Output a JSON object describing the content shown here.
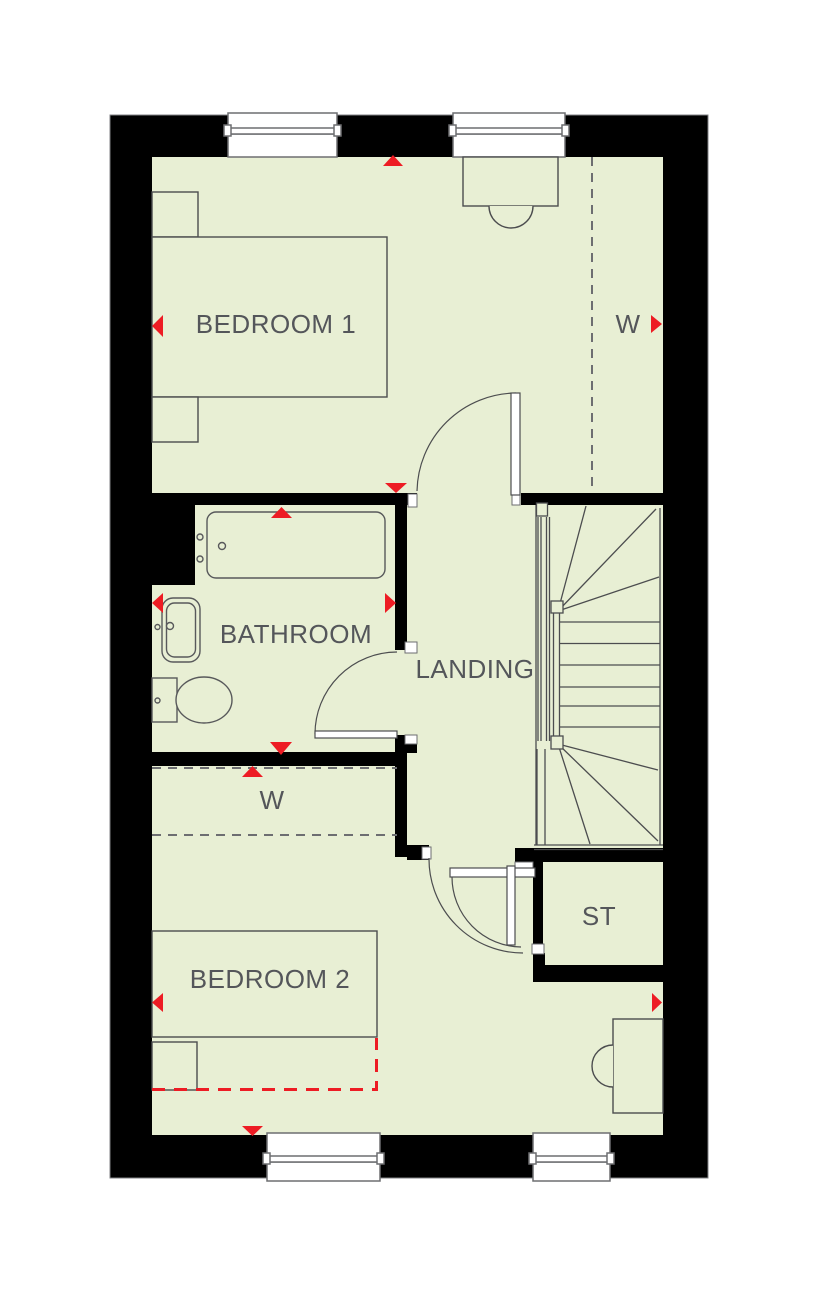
{
  "colors": {
    "floor": "#e8efd4",
    "wall": "#000000",
    "marker": "#ed1c24",
    "label": "#54565a",
    "line": "#4c4d4f",
    "fixture": "#58595b",
    "frame": "#6d6e71"
  },
  "rooms": {
    "bedroom1": {
      "label": "BEDROOM 1"
    },
    "wardrobe1": {
      "label": "W"
    },
    "bathroom": {
      "label": "BATHROOM"
    },
    "landing": {
      "label": "LANDING"
    },
    "wardrobe2": {
      "label": "W"
    },
    "storage": {
      "label": "ST"
    },
    "bedroom2": {
      "label": "BEDROOM 2"
    }
  }
}
